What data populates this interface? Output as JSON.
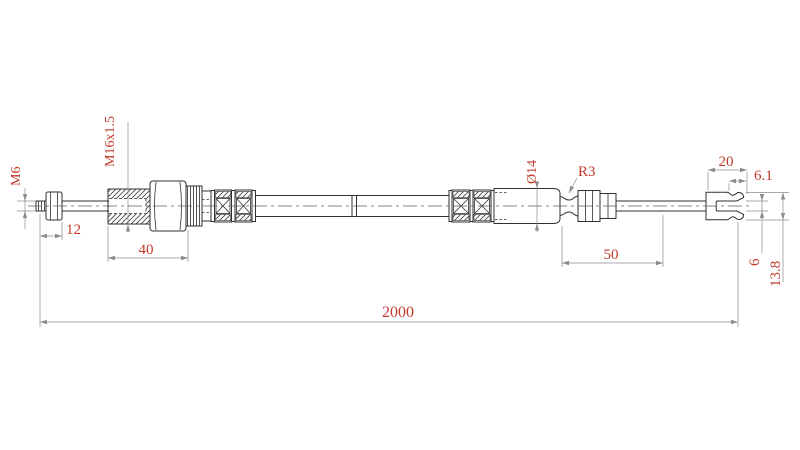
{
  "drawing": {
    "kind": "technical-drawing-cable",
    "colors": {
      "outline": "#2f2f2f",
      "dimension_line": "#8c8c8c",
      "dimension_text": "#c0392b",
      "background": "#ffffff"
    },
    "dimensions": {
      "left_thread": "M6",
      "mount_thread": "M16x1.5",
      "left_tip_length": "12",
      "mount_body_length": "40",
      "sleeve_diameter": "Ø14",
      "groove_radius": "R3",
      "end_fitting_length": "50",
      "fork_length": "20",
      "fork_slot_depth": "6.1",
      "fork_slot_width": "6",
      "fork_height": "13.8",
      "total_length": "2000"
    }
  }
}
